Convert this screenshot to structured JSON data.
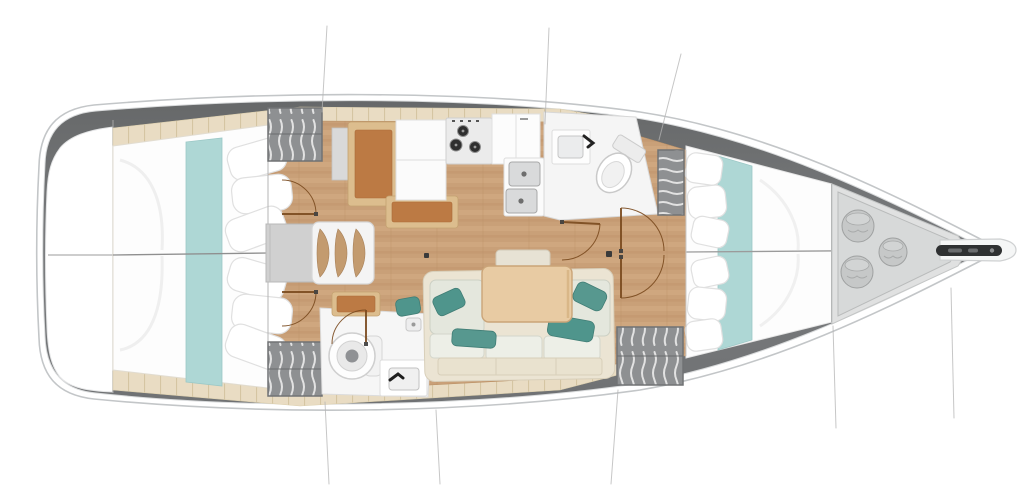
{
  "title": "Sailing yacht interior layout plan, top-down view, bow pointing right",
  "palette": {
    "page_bg": "#ffffff",
    "hull_outline": "#c3c6c8",
    "hull_band_dark": "#6d6f71",
    "sidedeck_trim": "#e9dcc3",
    "floor_wood": "#c9a078",
    "furniture_wood": "#bc7a44",
    "furniture_wood_frame": "#dcbd8e",
    "bed_linen": "#ffffff",
    "berth_runner_teal": "#aed7d5",
    "accent_pillow_teal": "#4f958c",
    "sofa_upholstery": "#e4e7dd",
    "sofa_base_cream": "#ebe4d3",
    "wardrobe_gray": "#8e9092",
    "fixture_white": "#f5f5f5",
    "engine_box_gray": "#d0d0d0",
    "locker_gray": "#d7d9d9",
    "step_tread_tan": "#c39b6f",
    "door_arc_brown": "#7a4a1e",
    "table_wood": "#e8cba3"
  },
  "areas": {
    "hull": {
      "label": "Hull outline with side decks, stern left, bow right"
    },
    "stern_platform": {
      "label": "Stern transom platform"
    },
    "aft_cabin_port": {
      "label": "Aft cabin port side - double berth with teal runner and pillows"
    },
    "aft_cabin_starboard": {
      "label": "Aft cabin starboard side - double berth with teal runner and pillows"
    },
    "companionway": {
      "label": "Companionway - three curved steps and engine compartment"
    },
    "galley": {
      "label": "Galley - nav desk, bench, cabinets, three-burner stove, counters and double sink"
    },
    "forward_head": {
      "label": "Forward head compartment - washbasin and toilet"
    },
    "aft_head": {
      "label": "Aft head compartment - toilet, washbasin and shower drain"
    },
    "salon": {
      "label": "Salon - settee with cushions, accent pillows and dining table"
    },
    "forward_cabin": {
      "label": "Forward cabin - V-berth with teal runner, pillows and dressing area"
    },
    "wardrobes": {
      "label": "Hanging wardrobe lockers with clothes"
    },
    "bow_locker": {
      "label": "Bow sail locker holding three fenders"
    },
    "bowsprit": {
      "label": "Bow fitting with anchor roller slot"
    },
    "rigging_lines": {
      "label": "Thin shroud and section reference lines"
    },
    "door_arcs": {
      "label": "Door swing arcs"
    }
  }
}
